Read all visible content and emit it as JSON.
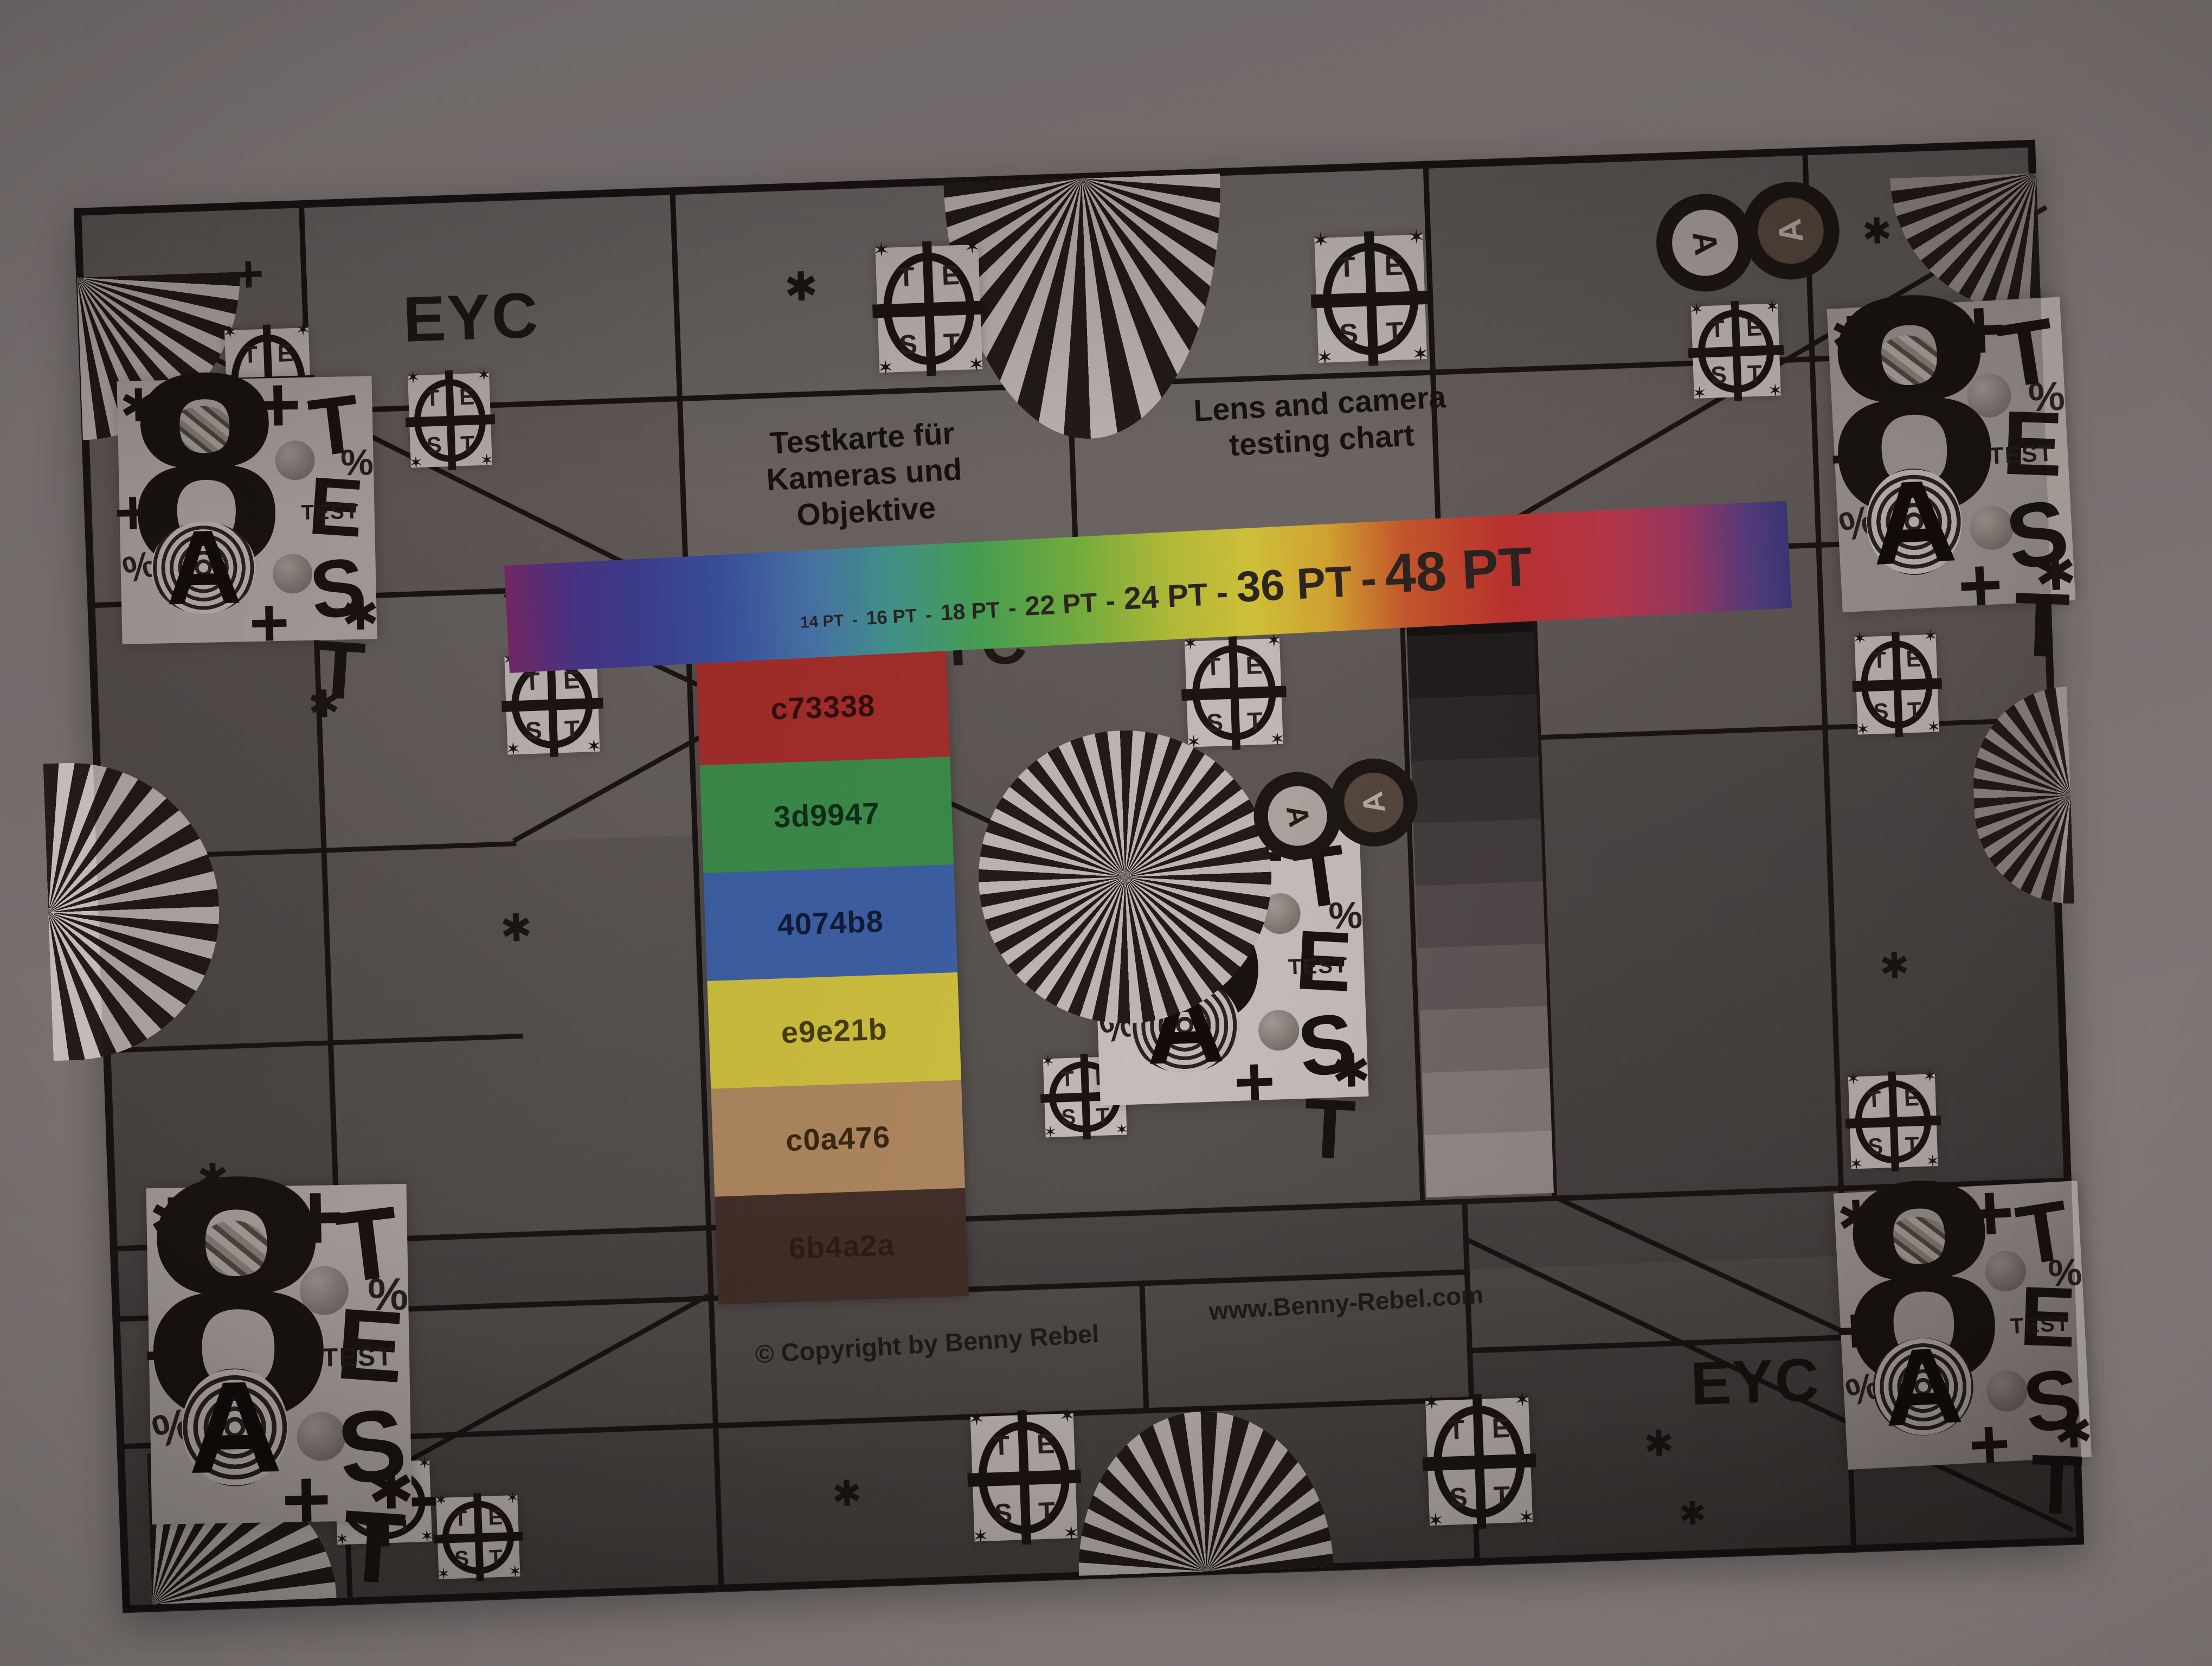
{
  "scene": {
    "description": "Dim photograph of a printed lens and camera test chart hanging on a wall",
    "wall_color": "#7a7372",
    "chart_background": "#5e5857",
    "grid_line_color": "#1b1514",
    "tile_background": "#c3bbb8",
    "ink_color": "#1c1613"
  },
  "header": {
    "brand": "EYC",
    "title_de_line1": "Testkarte für",
    "title_de_line2": "Kameras und Objektive",
    "title_en_line1": "Lens and camera",
    "title_en_line2": "testing chart"
  },
  "type_scale_bar": {
    "labels": [
      "14 PT",
      "16 PT",
      "18 PT",
      "22 PT",
      "24 PT",
      "36 PT",
      "48 PT"
    ],
    "separator": "-",
    "gradient": [
      "#7c2a6e",
      "#3f3f96",
      "#3c54a4",
      "#4a79ae",
      "#43988f",
      "#4aa554",
      "#7ab43f",
      "#b9bf3a",
      "#d4c53a",
      "#d8a832",
      "#cc5a2d",
      "#c43430",
      "#c23a4e",
      "#a23a68",
      "#5c3f88",
      "#3f3b80"
    ]
  },
  "swatches": [
    {
      "label": "c73338",
      "fill": "#a82f2b",
      "label_color": "#33100e"
    },
    {
      "label": "3d9947",
      "fill": "#3d8f4c",
      "label_color": "#0f2f1a"
    },
    {
      "label": "4074b8",
      "fill": "#3e62a8",
      "label_color": "#101c38"
    },
    {
      "label": "e9e21b",
      "fill": "#d2c440",
      "label_color": "#453f10"
    },
    {
      "label": "c0a476",
      "fill": "#b28a60",
      "label_color": "#3a2812"
    },
    {
      "label": "6b4a2a",
      "fill": "#44302a",
      "label_color": "#2e1f18"
    }
  ],
  "grayscale_steps": [
    "#171313",
    "#231e1e",
    "#2e2828",
    "#3a3333",
    "#463f3f",
    "#544c4c",
    "#635a5a",
    "#756b6b",
    "#877d7d",
    "#9a8f8f"
  ],
  "center": {
    "brand": "EYC"
  },
  "footer": {
    "copyright": "© Copyright by Benny Rebel",
    "website": "www.Benny-Rebel.com",
    "brand": "EYC"
  },
  "marker": {
    "eight": "8",
    "a": "A",
    "test_letters": [
      "T",
      "E",
      "S",
      "T"
    ],
    "test_word": "TEST",
    "plus": "+",
    "asterisk": "✱",
    "star4": "✶",
    "percent": "%"
  }
}
